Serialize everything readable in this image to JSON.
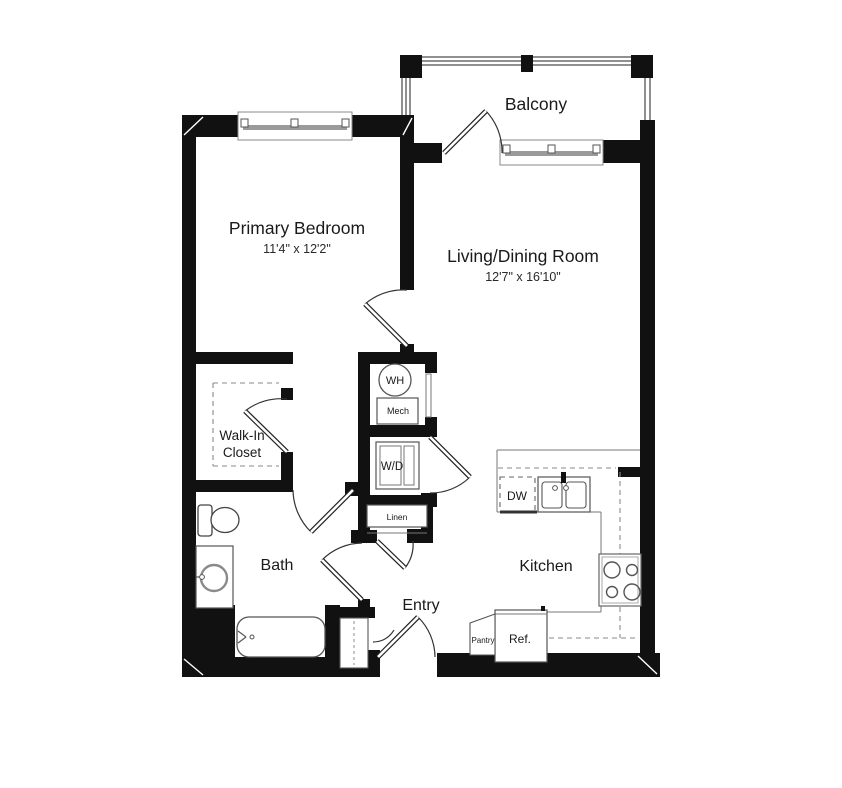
{
  "plan": {
    "rooms": {
      "balcony": {
        "label": "Balcony"
      },
      "primary_bedroom": {
        "label": "Primary Bedroom",
        "dimensions": "11'4\" x 12'2\""
      },
      "living_dining": {
        "label": "Living/Dining Room",
        "dimensions": "12'7\" x 16'10\""
      },
      "walk_in_closet": {
        "label_line1": "Walk-In",
        "label_line2": "Closet"
      },
      "bath": {
        "label": "Bath"
      },
      "entry": {
        "label": "Entry"
      },
      "kitchen": {
        "label": "Kitchen"
      }
    },
    "fixtures": {
      "water_heater": {
        "label": "WH"
      },
      "mechanical": {
        "label": "Mech"
      },
      "washer_dryer": {
        "label": "W/D"
      },
      "linen": {
        "label": "Linen"
      },
      "dishwasher": {
        "label": "DW"
      },
      "refrigerator": {
        "label": "Ref."
      },
      "pantry": {
        "label": "Pantry"
      }
    },
    "colors": {
      "wall": "#111111",
      "background": "#ffffff",
      "fixture_line": "#555555",
      "dashed_line": "#8a8a8a",
      "text": "#1a1a1a"
    }
  }
}
